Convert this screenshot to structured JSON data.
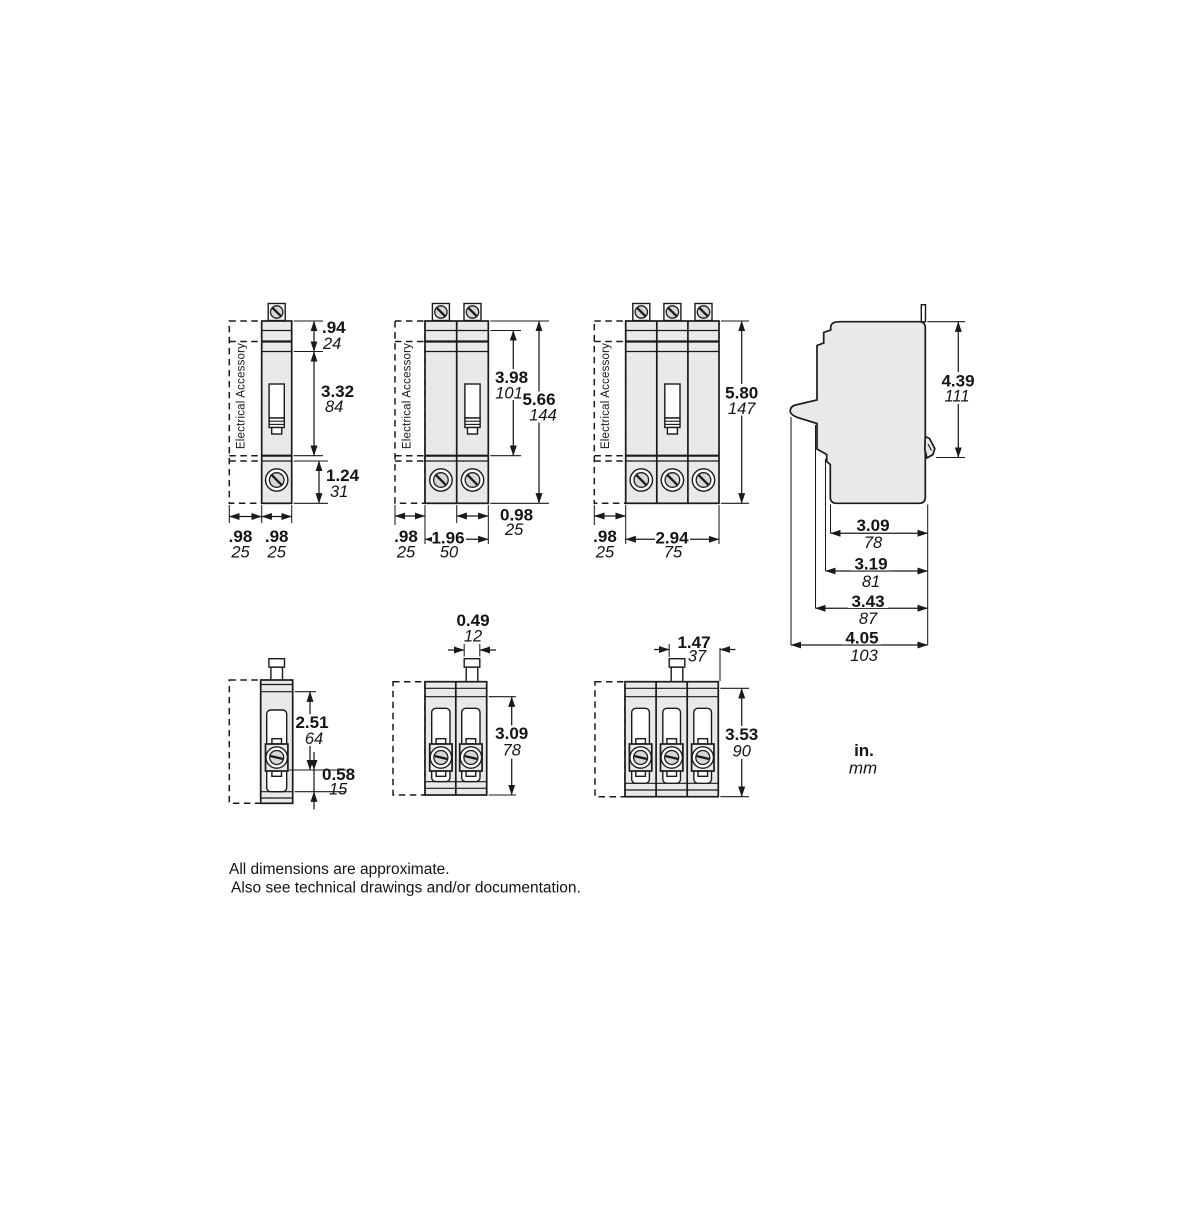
{
  "accessory_label": "Electrical Accessory",
  "legend": {
    "inches": "in.",
    "millimeters": "mm"
  },
  "notes": {
    "line1": "All dimensions are approximate.",
    "line2": "Also see technical drawings and/or documentation."
  },
  "views": {
    "front_1pole": {
      "dims": {
        "terminal_height": {
          "in": ".94",
          "mm": "24"
        },
        "body_height": {
          "in": "3.32",
          "mm": "84"
        },
        "lug_height": {
          "in": "1.24",
          "mm": "31"
        },
        "accessory_width": {
          "in": ".98",
          "mm": "25"
        },
        "pole_width": {
          "in": ".98",
          "mm": "25"
        }
      }
    },
    "front_2pole": {
      "dims": {
        "upper_height": {
          "in": "3.98",
          "mm": "101"
        },
        "total_height": {
          "in": "5.66",
          "mm": "144"
        },
        "pole_width": {
          "in": "0.98",
          "mm": "25"
        },
        "accessory_width": {
          "in": ".98",
          "mm": "25"
        },
        "total_width": {
          "in": "1.96",
          "mm": "50"
        }
      }
    },
    "front_3pole": {
      "dims": {
        "total_height": {
          "in": "5.80",
          "mm": "147"
        },
        "accessory_width": {
          "in": ".98",
          "mm": "25"
        },
        "total_width": {
          "in": "2.94",
          "mm": "75"
        }
      }
    },
    "side": {
      "dims": {
        "height": {
          "in": "4.39",
          "mm": "111"
        },
        "depth_base": {
          "in": "3.09",
          "mm": "78"
        },
        "depth_mid": {
          "in": "3.19",
          "mm": "81"
        },
        "depth_body": {
          "in": "3.43",
          "mm": "87"
        },
        "depth_total": {
          "in": "4.05",
          "mm": "103"
        }
      }
    },
    "top_1pole": {
      "dims": {
        "body_depth": {
          "in": "2.51",
          "mm": "64"
        },
        "lug_depth": {
          "in": "0.58",
          "mm": "15"
        }
      }
    },
    "top_2pole": {
      "dims": {
        "handle_width": {
          "in": "0.49",
          "mm": "12"
        },
        "depth": {
          "in": "3.09",
          "mm": "78"
        }
      }
    },
    "top_3pole": {
      "dims": {
        "handle_width": {
          "in": "1.47",
          "mm": "37"
        },
        "depth": {
          "in": "3.53",
          "mm": "90"
        }
      }
    }
  },
  "colors": {
    "body_fill": "#e9e9e9",
    "line": "#1a1a1a",
    "screw_fill": "#d7d7d7",
    "background": "#ffffff"
  }
}
